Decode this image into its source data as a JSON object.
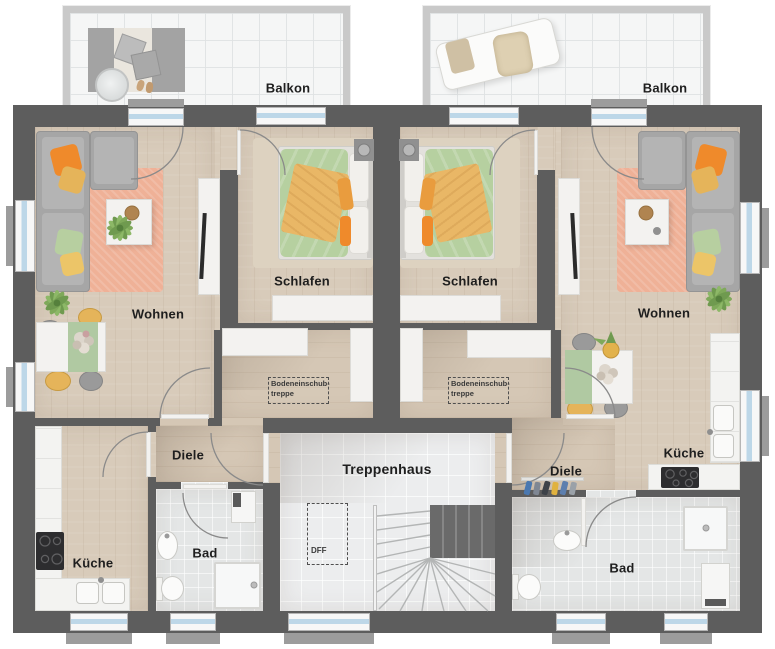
{
  "plan": {
    "rooms": {
      "balkon": "Balkon",
      "wohnen": "Wohnen",
      "schlafen": "Schlafen",
      "diele": "Diele",
      "kueche": "Küche",
      "bad": "Bad",
      "treppenhaus": "Treppenhaus",
      "dff": "DFF",
      "bodeneinschubtreppe": {
        "line1": "Bodeneinschub-",
        "line2": "treppe"
      }
    },
    "colors": {
      "wall": "#5d5d5d",
      "wood_floor": "#d8cbba",
      "bath_tile": "#e4e6e6",
      "stair_tile": "#ecedee",
      "balcony_tile": "#f5f6f6",
      "rug_peach": "#efb197",
      "duvet_green": "#b6d0a0",
      "blanket_orange": "#e9b766",
      "pillow_orange": "#ef8a2b",
      "pillow_yellow": "#e5b45a",
      "window_glass": "#bdd7e8"
    }
  }
}
